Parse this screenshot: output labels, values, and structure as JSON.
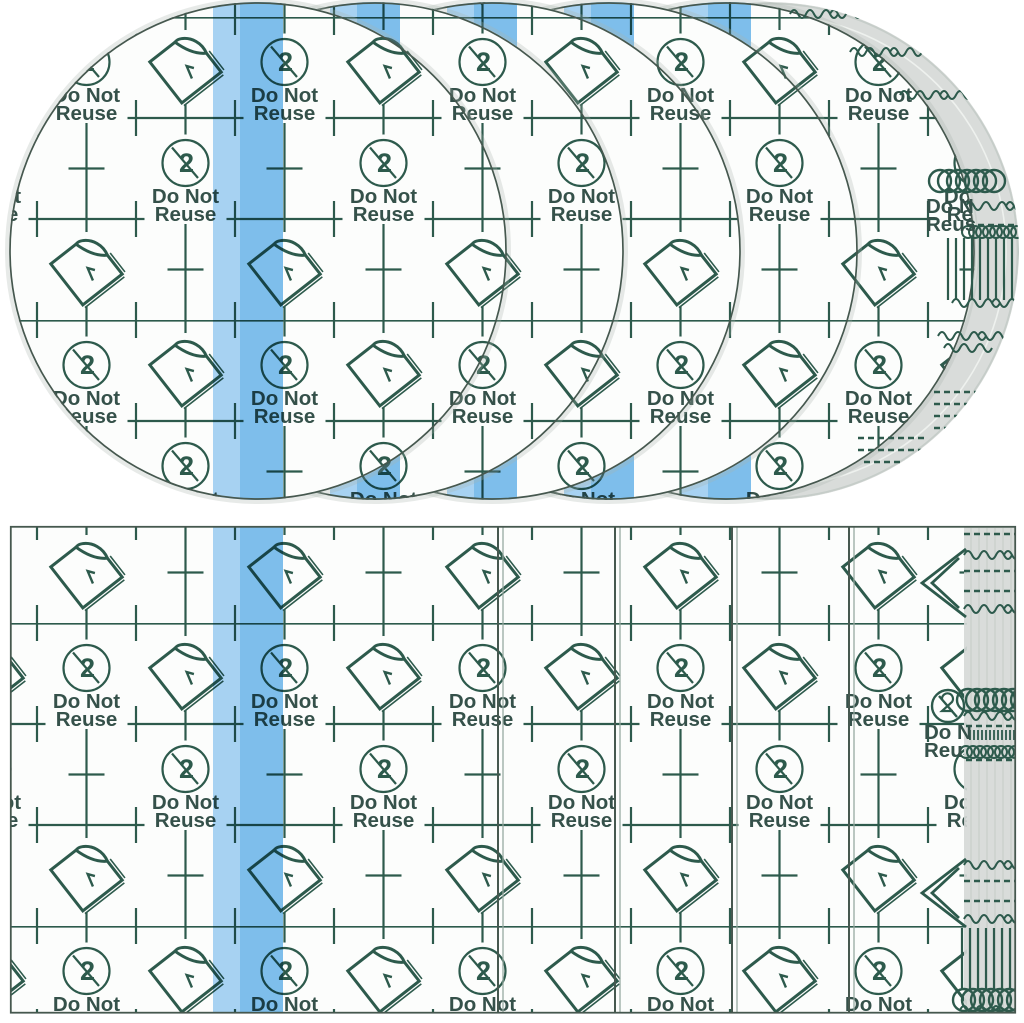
{
  "product_photo": {
    "subject": "Fanned stacks of transparent waterproof adhesive film dressings: five round patches on top, rectangular sheets below",
    "label": {
      "line1": "Do Not",
      "line2": "Reuse"
    },
    "no_reuse_glyph": "2",
    "edge_echo_label": {
      "line1": "Do N",
      "line2_top": "Reus",
      "line2_bottom": "Reu"
    },
    "colors": {
      "background": "#ffffff",
      "film_white": "#fcfdfc",
      "print_green": "#2d5a4c",
      "text_green": "#35514a",
      "stripe_light": "#a9d4f5",
      "stripe_main": "#7fc0ee",
      "stack_gray": "#d6d9d7",
      "edge_dark": "#46584f",
      "edge_light": "#95a79e"
    },
    "top_stack": {
      "shape": "circle",
      "visible_layers": 5
    },
    "bottom_stack": {
      "shape": "rectangle",
      "visible_layers": 5
    }
  }
}
